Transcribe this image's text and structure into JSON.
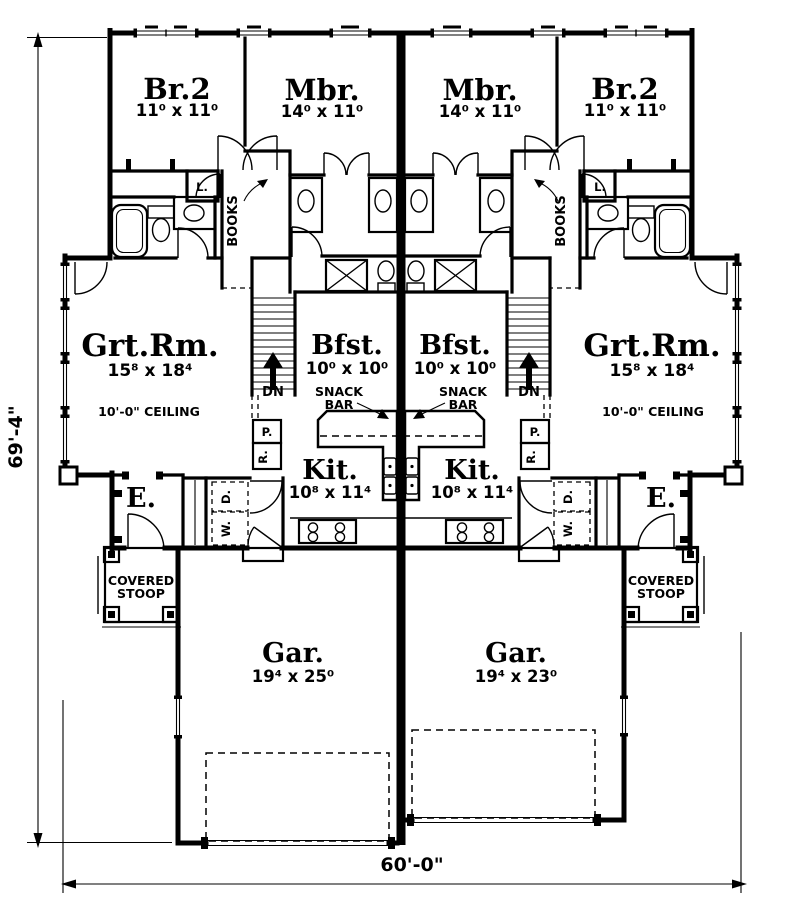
{
  "page": {
    "background": "#ffffff",
    "ink_color": "#000000"
  },
  "dimensions": {
    "height_label": "69'-4\"",
    "width_label": "60'-0\""
  },
  "labels": {
    "snack_line1": "SNACK",
    "snack_line2": "BAR",
    "stoop_line1": "COVERED",
    "stoop_line2": "STOOP",
    "down": "DN",
    "books": "BOOKS",
    "entry": "E.",
    "linen": "L.",
    "pantry": "P.",
    "refrigerator": "R.",
    "washer": "W.",
    "dryer": "D.",
    "ceiling": "10'-0\" CEILING"
  },
  "units": {
    "left": {
      "bedroom2": {
        "name": "Br.2",
        "size": "11⁰ x 11⁰"
      },
      "master": {
        "name": "Mbr.",
        "size": "14⁰ x 11⁰"
      },
      "great_room": {
        "name": "Grt.Rm.",
        "size": "15⁸ x 18⁴"
      },
      "breakfast": {
        "name": "Bfst.",
        "size": "10⁰ x 10⁰"
      },
      "kitchen": {
        "name": "Kit.",
        "size": "10⁸ x 11⁴"
      },
      "garage": {
        "name": "Gar.",
        "size": "19⁴ x 25⁰"
      }
    },
    "right": {
      "bedroom2": {
        "name": "Br.2",
        "size": "11⁰ x 11⁰"
      },
      "master": {
        "name": "Mbr.",
        "size": "14⁰ x 11⁰"
      },
      "great_room": {
        "name": "Grt.Rm.",
        "size": "15⁸ x 18⁴"
      },
      "breakfast": {
        "name": "Bfst.",
        "size": "10⁰ x 10⁰"
      },
      "kitchen": {
        "name": "Kit.",
        "size": "10⁸ x 11⁴"
      },
      "garage": {
        "name": "Gar.",
        "size": "19⁴ x 23⁰"
      }
    }
  }
}
